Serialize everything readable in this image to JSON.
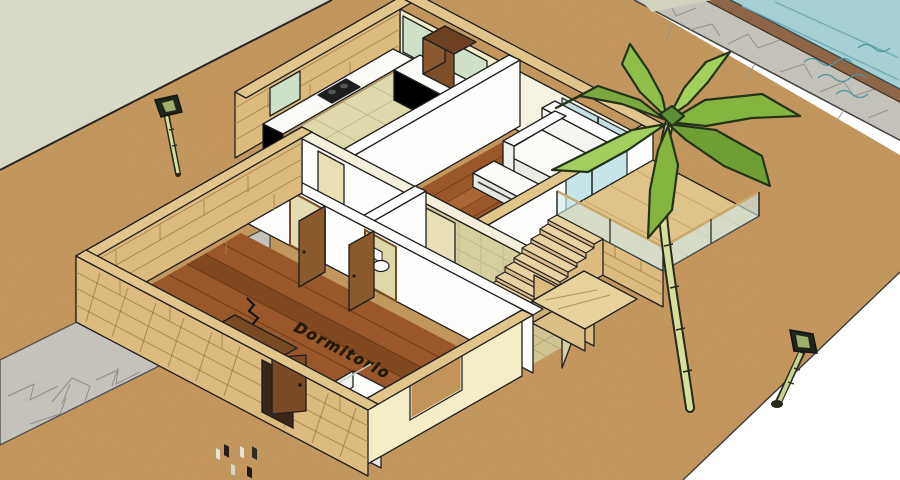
{
  "viewport": {
    "type": "3d-model-view",
    "description": "Cutaway isometric 3D house model (SketchUp style) with kitchen, living room, bathroom, bedroom, stairs to raised terrace, low-poly palm tree, swimming pool with stone deck, street and two street lamps",
    "width": 900,
    "height": 480
  },
  "labels": {
    "bedroom_floor": "Dormitorio"
  },
  "rooms": {
    "bedroom": "Dormitorio",
    "others_visible": [
      "kitchen",
      "living-room",
      "bathroom",
      "hallway",
      "terrace"
    ]
  },
  "colors": {
    "background": "#ffffff",
    "street": "#d9d9c8",
    "ground": "#c79a5f",
    "stone": "#c9c9c3",
    "pool_water": "#a9d8dd",
    "pool_rim": "#8f6749",
    "brick_wall": "#dcbc7e",
    "interior_wall": "#fdfdfc",
    "cream_wall": "#f5edc6",
    "tile_floor": "#ded8ab",
    "wood_floor": "#9a572a",
    "glass": "#bfdfe3",
    "kitchen_window_glass": "#cfe0c8",
    "palm_green": "#86b441",
    "palm_dark": "#5c8f33",
    "lamp_pole": "#d6de9b",
    "stairs_wood": "#e2cb96",
    "outline": "#1f1f1f"
  }
}
